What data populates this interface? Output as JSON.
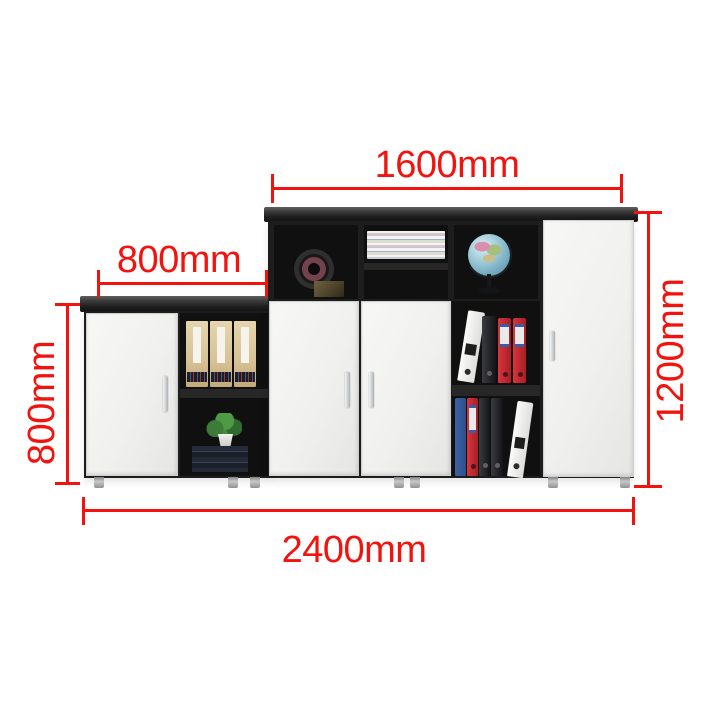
{
  "scene": {
    "description": "Black and white office storage cabinet combination with open cubbies (tape roll, magazine stack, globe, file boxes, plant, books, ring binders), annotated with red dimension lines on a white background"
  },
  "dimensions": {
    "upper_width": {
      "label": "1600mm"
    },
    "left_section_width": {
      "label": "800mm"
    },
    "left_section_height": {
      "label": "800mm"
    },
    "right_section_height": {
      "label": "1200mm"
    },
    "total_width": {
      "label": "2400mm"
    }
  },
  "colors": {
    "dimension_red": "#f2120e",
    "cabinet_black": "#1d1d1d",
    "interior_black": "#101010",
    "door_white": "#f1f1ef",
    "leg_silver": "#c6c8ca",
    "file_box_tan": "#d7c297",
    "binder_red": "#a91e26",
    "binder_blue": "#2e4f8e",
    "globe_blue": "#7fb4c8",
    "plant_green": "#4f9a45"
  },
  "objects": [
    "tape-roll",
    "magazine-stack",
    "globe",
    "file-boxes",
    "potted-plant",
    "book-stack",
    "ring-binders"
  ]
}
